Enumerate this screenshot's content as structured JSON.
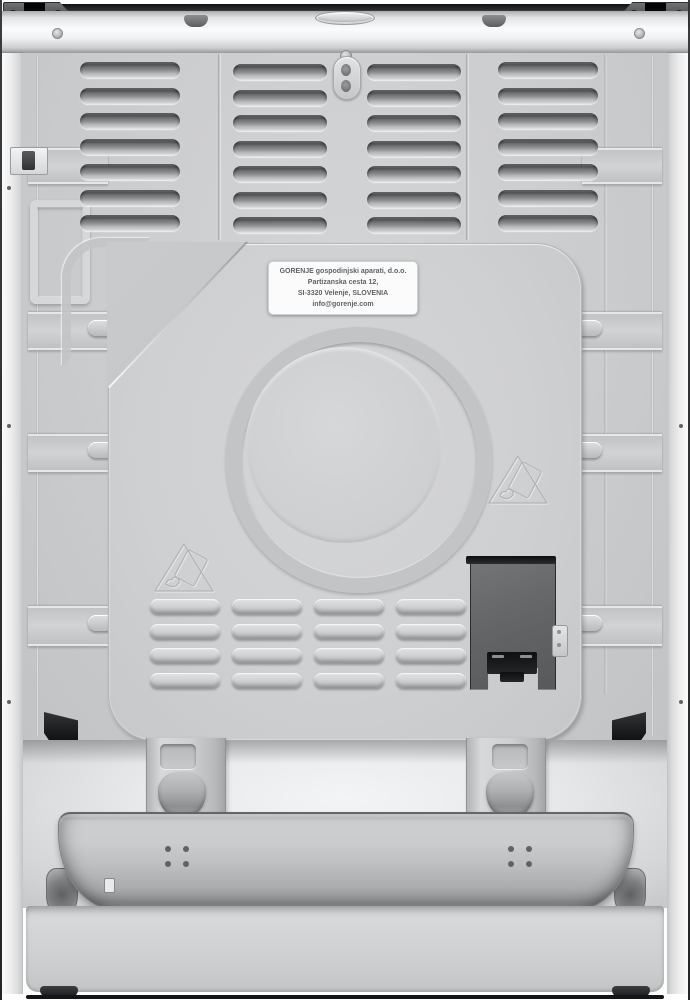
{
  "product": {
    "brand": "Gorenje",
    "description": "rear view of a freestanding cooker",
    "logo_badge": "oval embossed badge"
  },
  "rating_label": {
    "line1": "GORENJE gospodinjski aparati, d.o.o.",
    "line2": "Partizanska cesta 12,",
    "line3": "SI-3320 Velenje, SLOVENIA",
    "line4": "info@gorenje.com"
  },
  "back_panel": {
    "top_vent_columns": [
      {
        "name": "left",
        "slots": 7
      },
      {
        "name": "center-left",
        "slots": 7
      },
      {
        "name": "center-right",
        "slots": 7
      },
      {
        "name": "right",
        "slots": 7
      }
    ],
    "bottom_vent_grid": {
      "rows": 4,
      "columns": 4
    },
    "warning_triangles": 2,
    "warning_icon_meaning": "tip-over hazard warning"
  },
  "colors": {
    "panel_gray": "#cbccce",
    "center_panel_gray": "#cfd0d2",
    "white_trim": "#f1f2f3",
    "terminal_box": "#636567",
    "hinge_dark": "#404244",
    "top_bar_black": "#1a1c1e",
    "sticker_white": "#fbfbfb",
    "sticker_text": "#606264"
  }
}
